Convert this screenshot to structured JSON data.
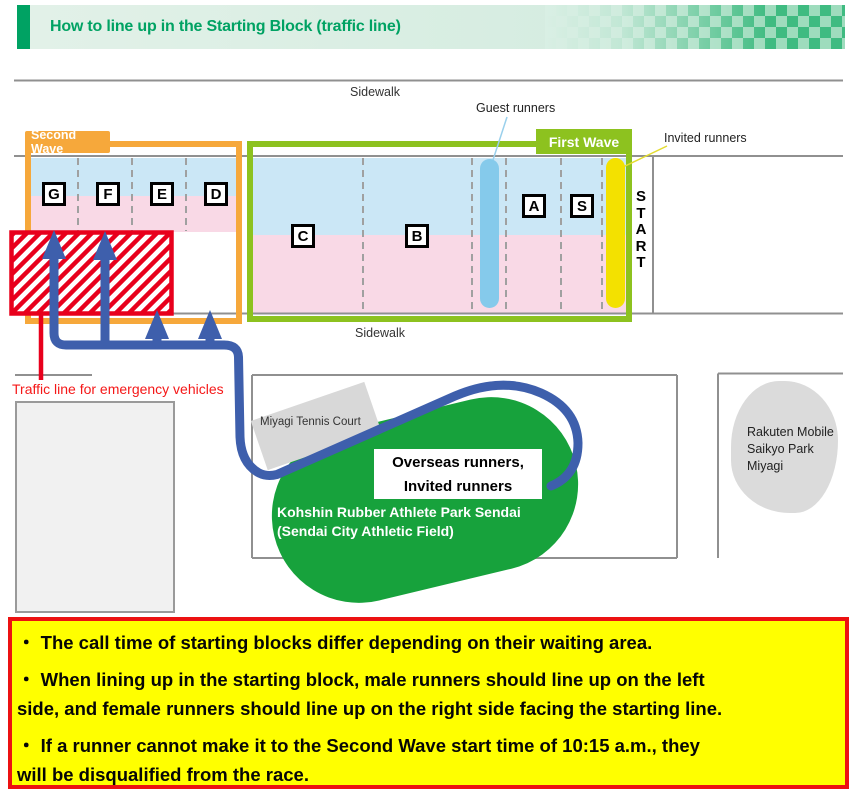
{
  "header": {
    "title": "How to line up in the Starting Block (traffic line)",
    "accent_color": "#00a263"
  },
  "map": {
    "sidewalk_top": "Sidewalk",
    "sidewalk_bottom": "Sidewalk",
    "guest_runners_label": "Guest runners",
    "invited_runners_label": "Invited runners",
    "second_wave_label": "Second Wave",
    "first_wave_label": "First Wave",
    "start_label": "S\nT\nA\nR\nT",
    "blocks": [
      "G",
      "F",
      "E",
      "D",
      "C",
      "B",
      "A",
      "S"
    ],
    "traffic_line_label": "Traffic line for emergency vehicles",
    "tennis_court_label": "Miyagi Tennis Court",
    "park_overlay": {
      "line1": "Overseas runners,",
      "line2": "Invited runners"
    },
    "park_name": {
      "line1": "Kohshin Rubber Athlete Park Sendai",
      "line2": "(Sendai City Athletic Field)"
    },
    "rakuten_label": "Rakuten Mobile\nSaikyo Park\nMiyagi",
    "colors": {
      "second_wave_orange": "#f6a83b",
      "first_wave_green": "#8dc21f",
      "zone_blue": "#cbe7f6",
      "zone_pink": "#f9d9e6",
      "guest_bar_blue": "#85caeb",
      "invited_bar_yellow": "#f3e100",
      "flow_path_blue": "#3e5fac",
      "park_green": "#17a23c",
      "emergency_red": "#e8001c"
    }
  },
  "notes": {
    "bullets": [
      {
        "lines": [
          "・ The call time of starting blocks differ depending on their waiting area."
        ]
      },
      {
        "lines": [
          "・ When lining up in the starting block, male runners should line up on the left",
          "side, and female runners should line up on the right side facing the starting line."
        ]
      },
      {
        "lines": [
          "・ If a runner cannot make it to the Second Wave start time of 10:15 a.m., they",
          "will be disqualified from the race."
        ]
      }
    ]
  }
}
